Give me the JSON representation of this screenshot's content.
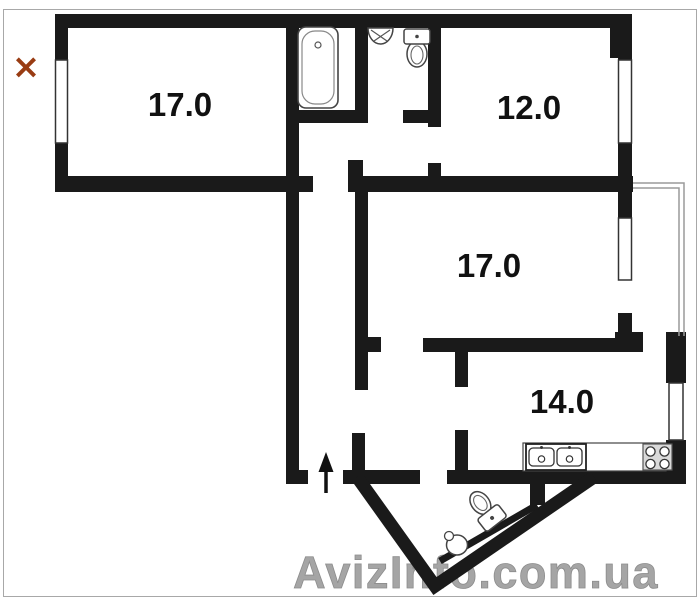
{
  "canvas": {
    "width": 700,
    "height": 600,
    "background": "#ffffff",
    "border_color": "#a8a8a8",
    "wall_color": "#1a1a1a"
  },
  "marker": {
    "glyph": "×",
    "color": "#993c13"
  },
  "rooms": [
    {
      "name": "room-top-left",
      "area_label": "17.0"
    },
    {
      "name": "room-top-right",
      "area_label": "12.0"
    },
    {
      "name": "room-middle",
      "area_label": "17.0"
    },
    {
      "name": "room-kitchen",
      "area_label": "14.0"
    }
  ],
  "fixtures": {
    "bathroom": [
      "bathtub",
      "wash-basin",
      "toilet"
    ],
    "kitchen": [
      "counter",
      "double-sink",
      "stove"
    ],
    "entrance_wc": [
      "toilet",
      "round-sink"
    ],
    "other": [
      "entrance-arrow",
      "balcony-railing",
      "windows"
    ]
  },
  "watermark": {
    "text": "AvizInfo.com.ua",
    "color": "#a5a5a5"
  }
}
